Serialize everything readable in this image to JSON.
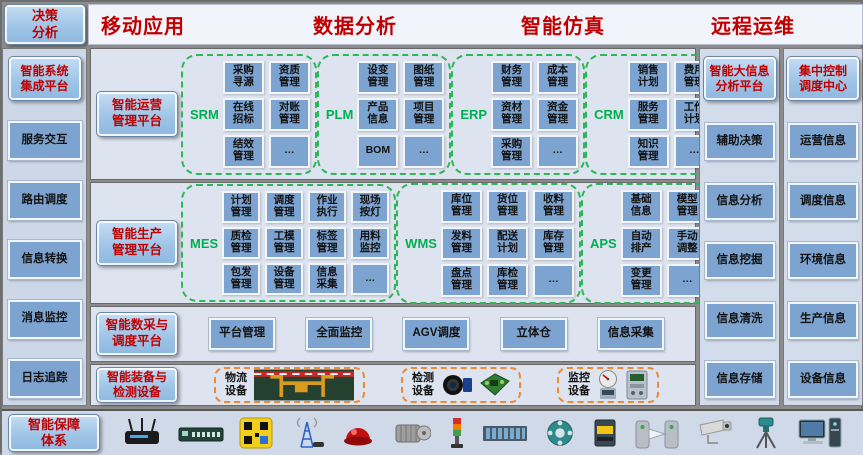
{
  "top": {
    "decision_label": "决策\n分析",
    "headers": [
      "移动应用",
      "数据分析",
      "智能仿真",
      "远程运维"
    ]
  },
  "left_panel": {
    "title": "智能系统\n集成平台",
    "items": [
      "服务交互",
      "路由调度",
      "信息转换",
      "消息监控",
      "日志追踪"
    ]
  },
  "operations": {
    "label": "智能运营\n管理平台",
    "groups": [
      {
        "name": "SRM",
        "cols": 2,
        "modules": [
          "采购\n寻源",
          "资质\n管理",
          "在线\n招标",
          "对账\n管理",
          "结效\n管理",
          "…"
        ]
      },
      {
        "name": "PLM",
        "cols": 2,
        "modules": [
          "设变\n管理",
          "图纸\n管理",
          "产品\n信息",
          "项目\n管理",
          "BOM",
          "…"
        ]
      },
      {
        "name": "ERP",
        "cols": 2,
        "modules": [
          "财务\n管理",
          "成本\n管理",
          "资材\n管理",
          "资金\n管理",
          "采购\n管理",
          "…"
        ]
      },
      {
        "name": "CRM",
        "cols": 2,
        "modules": [
          "销售\n计划",
          "费用\n管理",
          "服务\n管理",
          "工作\n计划",
          "知识\n管理",
          "…"
        ]
      }
    ]
  },
  "production": {
    "label": "智能生产\n管理平台",
    "groups": [
      {
        "name": "MES",
        "cols": 4,
        "modules": [
          "计划\n管理",
          "调度\n管理",
          "作业\n执行",
          "现场\n按灯",
          "质检\n管理",
          "工模\n管理",
          "标签\n管理",
          "用料\n监控",
          "包发\n管理",
          "设备\n管理",
          "信息\n采集",
          "…"
        ]
      },
      {
        "name": "WMS",
        "cols": 3,
        "modules": [
          "库位\n管理",
          "货位\n管理",
          "收料\n管理",
          "发料\n管理",
          "配送\n计划",
          "库存\n管理",
          "盘点\n管理",
          "库检\n管理",
          "…"
        ]
      },
      {
        "name": "APS",
        "cols": 2,
        "modules": [
          "基础\n信息",
          "模型\n管理",
          "自动\n排产",
          "手动\n调整",
          "变更\n管理",
          "…"
        ]
      }
    ]
  },
  "daq": {
    "label": "智能数采与\n调度平台",
    "items": [
      "平台管理",
      "全面监控",
      "AGV调度",
      "立体仓",
      "信息采集"
    ]
  },
  "equipment": {
    "label": "智能装备与\n检测设备",
    "groups": [
      {
        "label": "物流\n设备",
        "icons": [
          "gantry-crane"
        ]
      },
      {
        "label": "检测\n设备",
        "icons": [
          "inspection-camera",
          "circuit-board"
        ]
      },
      {
        "label": "监控\n设备",
        "icons": [
          "gauge-meter",
          "energy-meter"
        ]
      }
    ]
  },
  "right_panel_analysis": {
    "title": "智能大信息\n分析平台",
    "items": [
      "辅助决策",
      "信息分析",
      "信息挖掘",
      "信息清洗",
      "信息存储"
    ]
  },
  "right_panel_control": {
    "title": "集中控制\n调度中心",
    "items": [
      "运营信息",
      "调度信息",
      "环境信息",
      "生产信息",
      "设备信息"
    ]
  },
  "bottom": {
    "title": "智能保障\n体系",
    "devices": [
      "wireless-router",
      "network-switch",
      "qr-scanner",
      "antenna-tower",
      "alarm-beacon",
      "electric-motor",
      "stack-light",
      "terminal-blocks",
      "rotary-encoder",
      "safety-sensor",
      "turnstile-gate",
      "cctv-camera",
      "survey-instrument",
      "computer-workstation"
    ]
  },
  "colors": {
    "accent_red": "#c00000",
    "module_blue": "#7da4d0",
    "header_blue": "#9dc3e6",
    "group_green": "#00b050",
    "dashed_green": "#2db757",
    "dashed_orange": "#ed8a33"
  }
}
